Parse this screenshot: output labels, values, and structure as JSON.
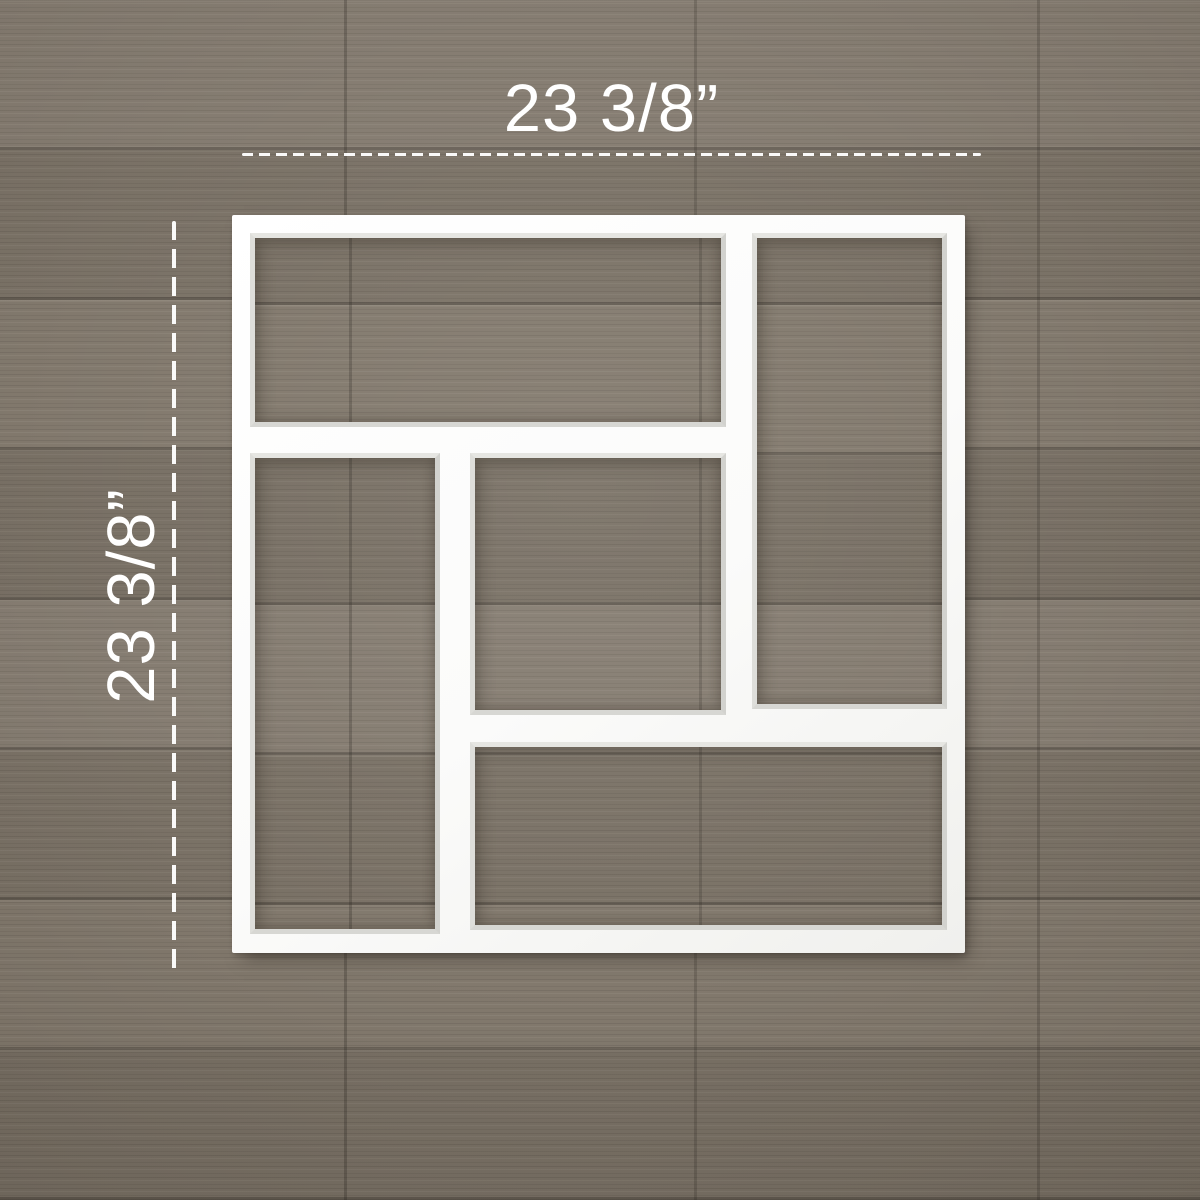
{
  "annotations": {
    "width_label": "23 3/8”",
    "height_label": "23 3/8”"
  },
  "colors": {
    "frame_white": "#fbfbfa",
    "annotation_white": "#ffffff",
    "wood_base": "#7c7367"
  }
}
